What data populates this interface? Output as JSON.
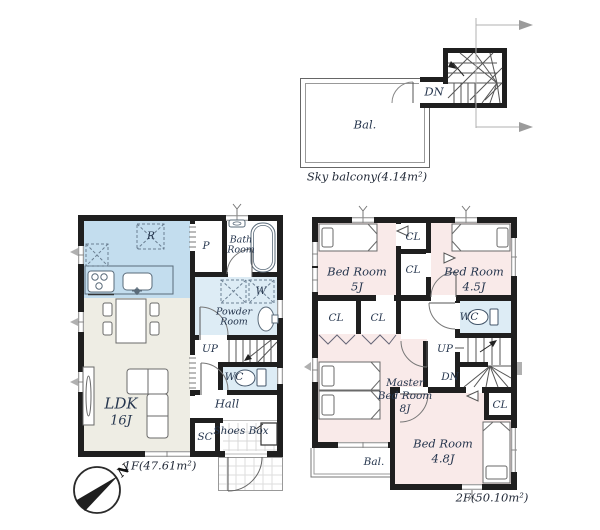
{
  "colors": {
    "wall": "#1f1f1f",
    "kitchen_fill": "#c3ddee",
    "wet_area_fill": "#ddecf5",
    "ldk_fill": "#eeede4",
    "bedroom_fill": "#f9eae9",
    "label_text": "#26364e",
    "thin_line": "#666666",
    "dimension_gray": "#9b9b9b"
  },
  "sky_balcony": {
    "balcony": "Bal.",
    "down": "DN",
    "caption": "Sky balcony(4.14m²)"
  },
  "floor1": {
    "caption": "1F(47.61m²)",
    "ldk_name": "LDK",
    "ldk_size": "16J",
    "pantry": "P",
    "bath_l1": "Bath",
    "bath_l2": "Room",
    "powder_l1": "Powder",
    "powder_l2": "Room",
    "wc": "WC",
    "hall": "Hall",
    "sc": "SC",
    "shoes_box": "Shoes Box",
    "up": "UP",
    "fridge": "R",
    "washer": "W",
    "compass_north": "N"
  },
  "floor2": {
    "caption": "2F(50.10m²)",
    "bedroom1_name": "Bed Room",
    "bedroom1_size": "5J",
    "bedroom2_name": "Bed Room",
    "bedroom2_size": "4.5J",
    "master_l1": "Master",
    "master_l2": "Bed Room",
    "master_size": "8J",
    "bedroom3_name": "Bed Room",
    "bedroom3_size": "4.8J",
    "wc": "WC",
    "up": "UP",
    "down": "DN",
    "closet": "CL",
    "balcony": "Bal."
  }
}
